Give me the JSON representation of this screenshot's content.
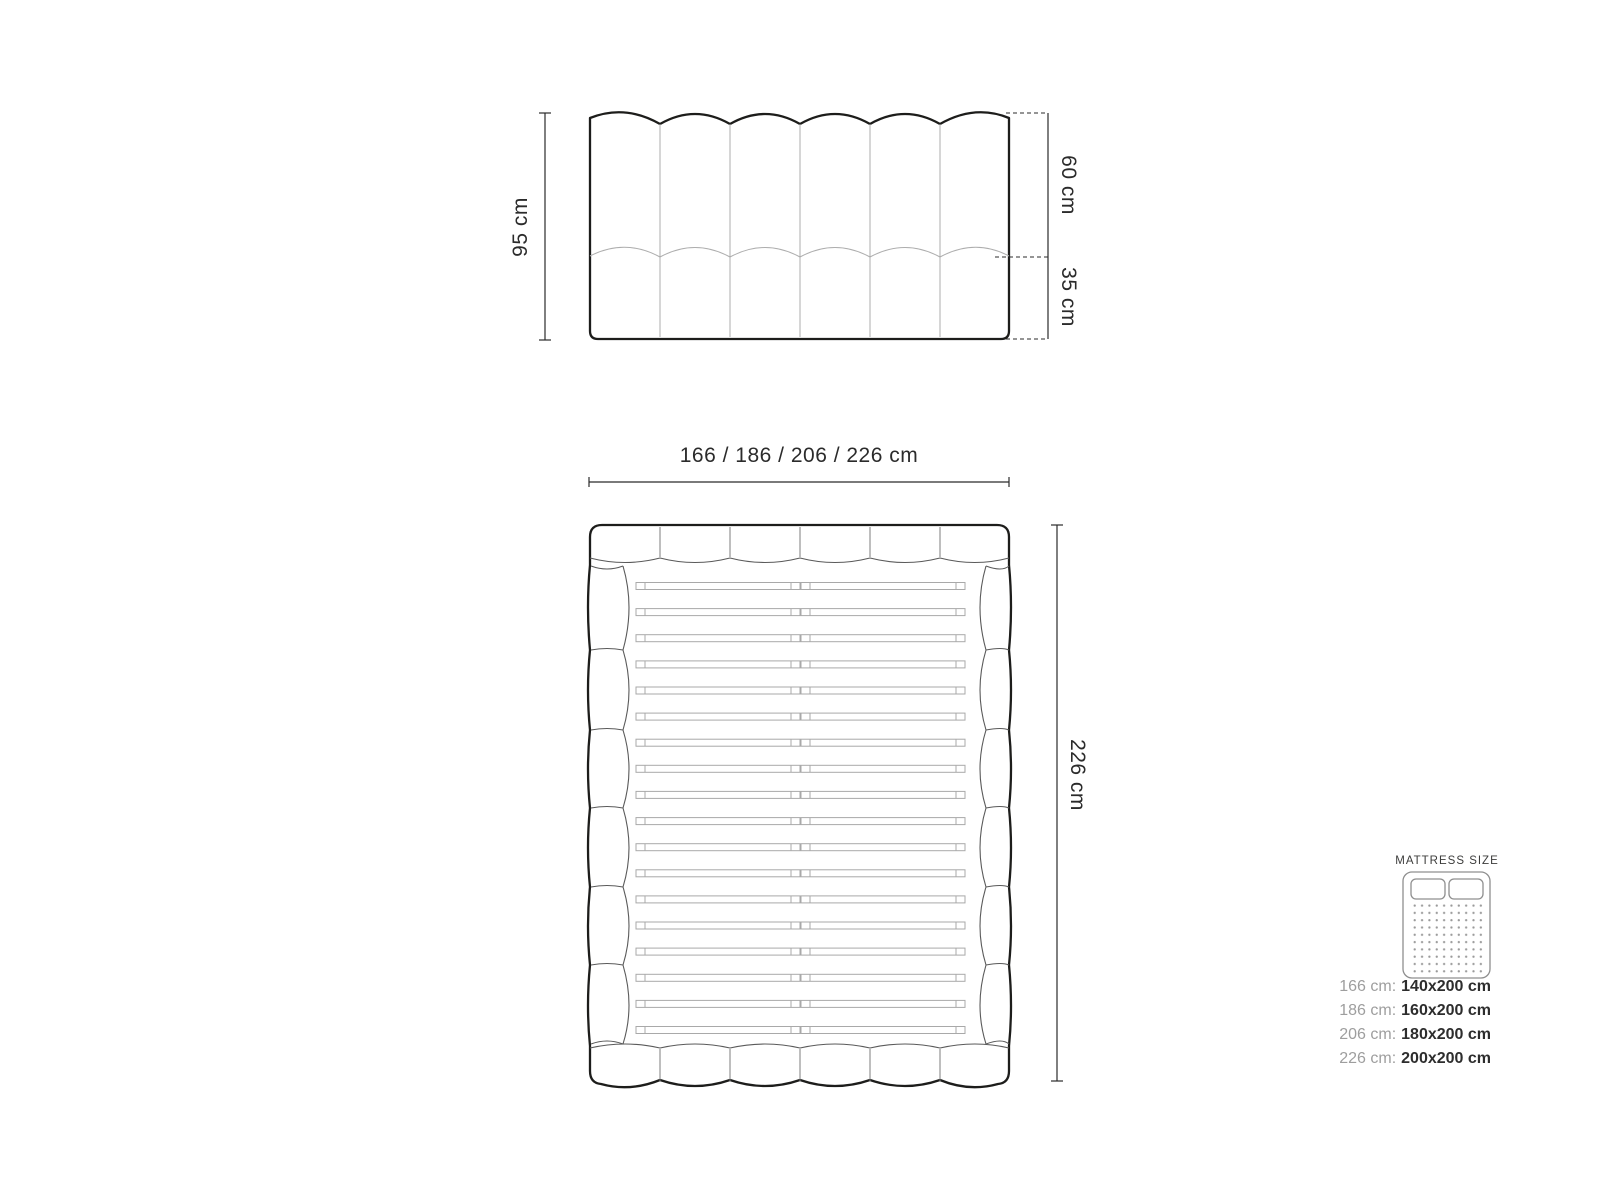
{
  "diagram_title": "Bed dimension diagram",
  "front_view": {
    "height_label": "95 cm",
    "headboard_height_label": "60 cm",
    "base_height_label": "35 cm",
    "channel_count": 6
  },
  "top_view": {
    "width_label": "166 / 186 / 206 / 226 cm",
    "depth_label": "226 cm",
    "slat_count": 18,
    "headboard_segment_count": 6,
    "footboard_segment_count": 6,
    "side_rail_segment_count": 6
  },
  "legend": {
    "title": "MATTRESS SIZE",
    "rows": [
      {
        "frame": "166 cm:",
        "mattress": "140x200 cm"
      },
      {
        "frame": "186 cm:",
        "mattress": "160x200 cm"
      },
      {
        "frame": "206 cm:",
        "mattress": "180x200 cm"
      },
      {
        "frame": "226 cm:",
        "mattress": "200x200 cm"
      }
    ]
  },
  "colors": {
    "background": "#ffffff",
    "outline": "#1d1d1b",
    "inner_line": "#adadad",
    "detail_line": "#5a5a5a",
    "dimension": "#2b2b2b",
    "legend_gray": "#9e9e9e",
    "legend_dark": "#2d2d2d",
    "icon_stroke": "#8f8f8f"
  }
}
